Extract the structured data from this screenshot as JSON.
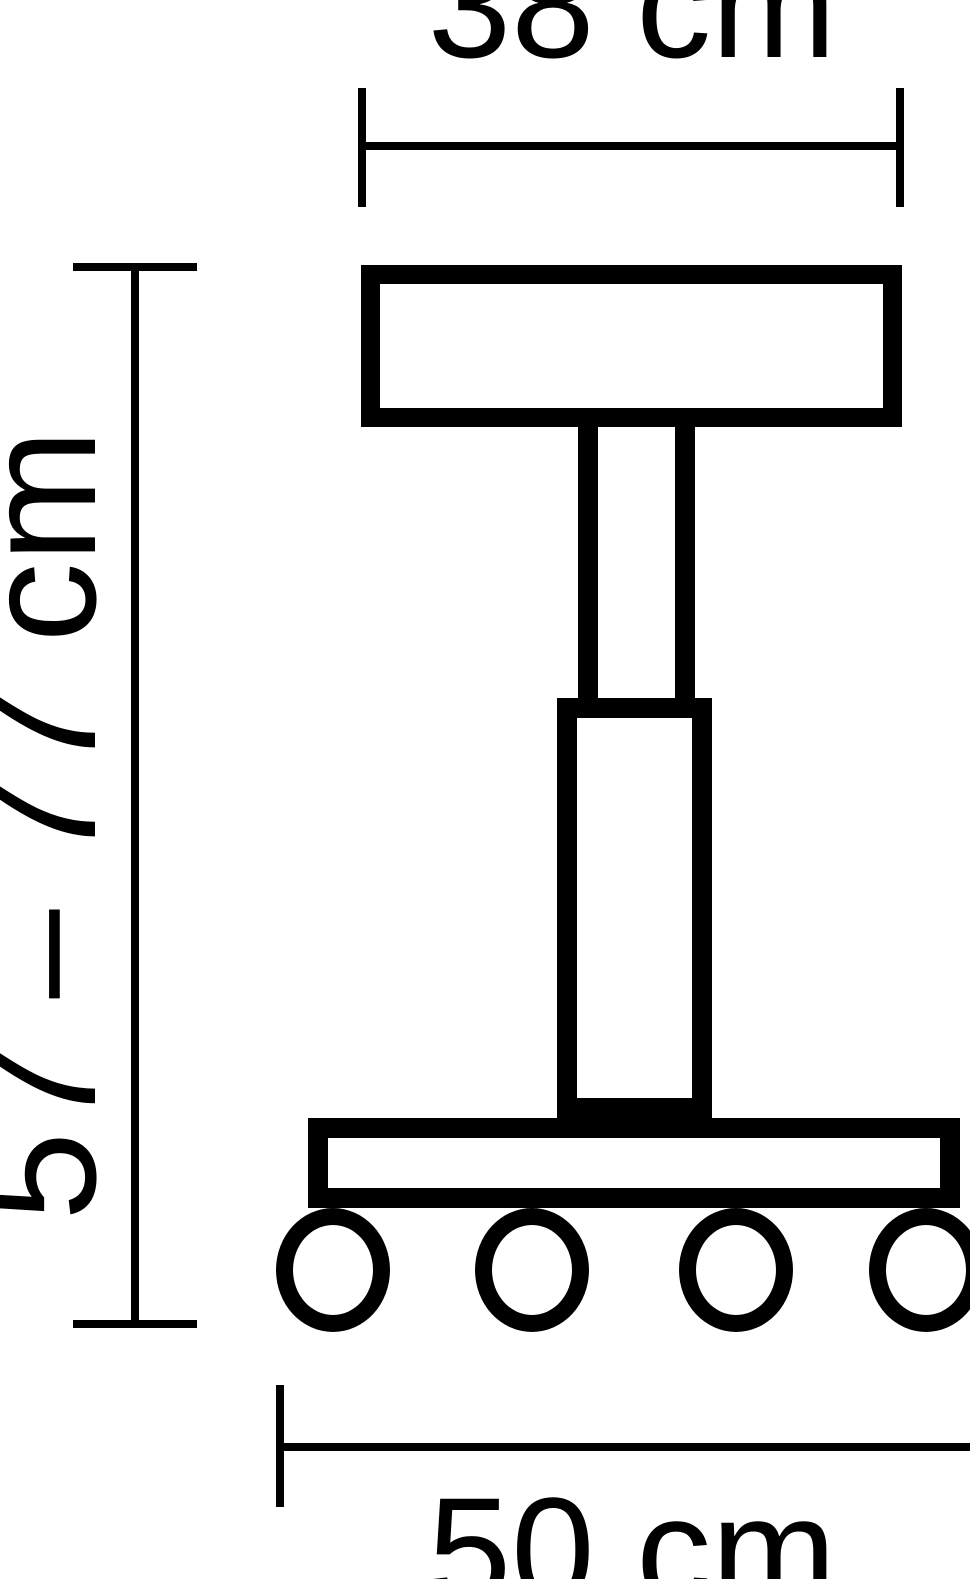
{
  "diagram": {
    "kind": "product-dimension-drawing",
    "subject": "height-adjustable stool with casters",
    "background_color": "#ffffff",
    "line_color": "#000000",
    "dimensions": {
      "top": {
        "label": "38 cm",
        "measures": "seat width"
      },
      "left": {
        "label": "57 – 77 cm",
        "measures": "overall height range"
      },
      "bottom": {
        "label": "50 cm",
        "measures": "base width"
      }
    },
    "caster_count": 4
  }
}
